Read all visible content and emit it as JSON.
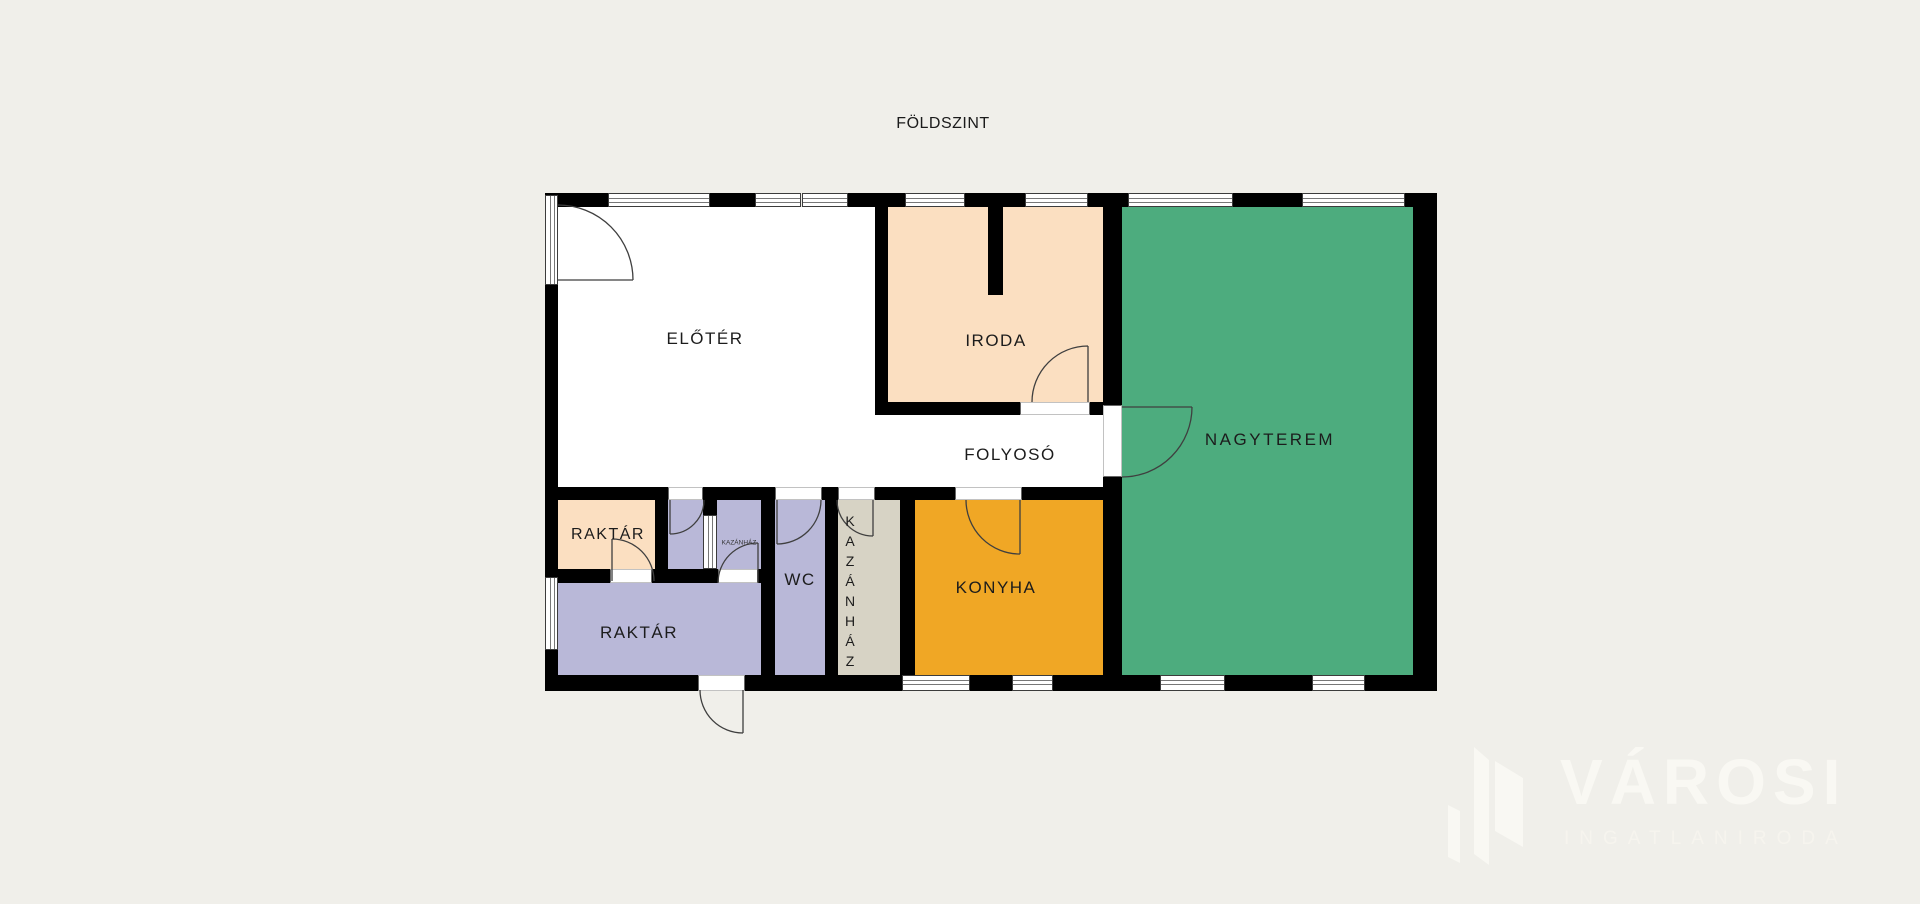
{
  "title": "FÖLDSZINT",
  "colors": {
    "background": "#f0efea",
    "wall": "#000000",
    "eloter": "#ffffff",
    "iroda": "#fbdfc1",
    "nagyterem": "#4dac7e",
    "konyha": "#f0a725",
    "raktar": "#b9b8d8",
    "raktar_small": "#fbdfc1",
    "wc": "#b9b8d8",
    "kazanhaz": "#d7d3c5"
  },
  "rooms": {
    "eloter": "ELŐTÉR",
    "iroda": "IRODA",
    "nagyterem": "NAGYTEREM",
    "folyoso": "FOLYOSÓ",
    "raktar_small": "RAKTÁR",
    "raktar_large": "RAKTÁR",
    "wc": "WC",
    "konyha": "KONYHA",
    "kazanhaz": "KAZÁNHÁZ",
    "kazanhaz_small": "KAZÁNHÁZ"
  },
  "watermark": {
    "brand": "VÁROSI",
    "subtitle": "INGATLANIRODA"
  }
}
